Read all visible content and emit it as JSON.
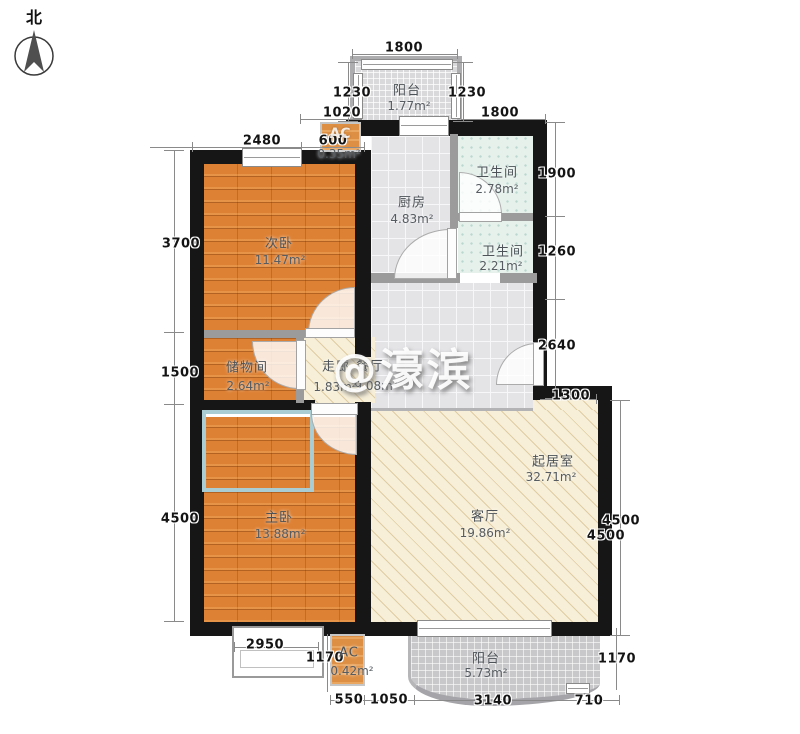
{
  "north": {
    "label": "北"
  },
  "watermark": {
    "text": "@濠滨"
  },
  "rooms": {
    "balcony_top": {
      "name": "阳台",
      "area": "1.77m²"
    },
    "ac_top": {
      "name": "AC",
      "area": "0.35m²"
    },
    "kitchen": {
      "name": "厨房",
      "area": "4.83m²"
    },
    "bath1": {
      "name": "卫生间",
      "area": "2.78m²"
    },
    "bath2": {
      "name": "卫生间",
      "area": "2.21m²"
    },
    "bedroom2": {
      "name": "次卧",
      "area": "11.47m²"
    },
    "storage": {
      "name": "储物间",
      "area": "2.64m²"
    },
    "corridor": {
      "name": "走廊",
      "area": "1.83m²"
    },
    "dining": {
      "name": "餐厅",
      "area": "9.08m²"
    },
    "living_zone": {
      "name": "起居室",
      "area": "32.71m²"
    },
    "living_room": {
      "name": "客厅",
      "area": "19.86m²"
    },
    "master": {
      "name": "主卧",
      "area": "13.88m²"
    },
    "balcony_bottom": {
      "name": "阳台",
      "area": "5.73m²"
    },
    "ac_bottom": {
      "name": "AC",
      "area": "0.42m²"
    }
  },
  "dims": {
    "top_1800": "1800",
    "balcony_left_1230": "1230",
    "balcony_right_1230": "1230",
    "left_1020": "1020",
    "right_1800": "1800",
    "bedroom2_2480": "2480",
    "bedroom2_600": "600",
    "left_3700": "3700",
    "left_1500": "1500",
    "left_4500": "4500",
    "right_1900": "1900",
    "right_1260": "1260",
    "right_2640": "2640",
    "right_1300": "1300",
    "right_4500_a": "4500",
    "right_4500_b": "4500",
    "bottom_2950": "2950",
    "bottom_left_1170": "1170",
    "bottom_550": "550",
    "bottom_1050": "1050",
    "bottom_3140": "3140",
    "bottom_710": "710",
    "bottom_right_1170": "1170"
  },
  "colors": {
    "wall": "#161616",
    "wood_floor": "#dd8134",
    "tile_floor": "#e4e4e7",
    "bath_tile": "#e7f1ec",
    "living_floor": "#f7efd8",
    "bay_accent": "#a9cdd2",
    "balcony_tile": "#c8c8cb"
  }
}
